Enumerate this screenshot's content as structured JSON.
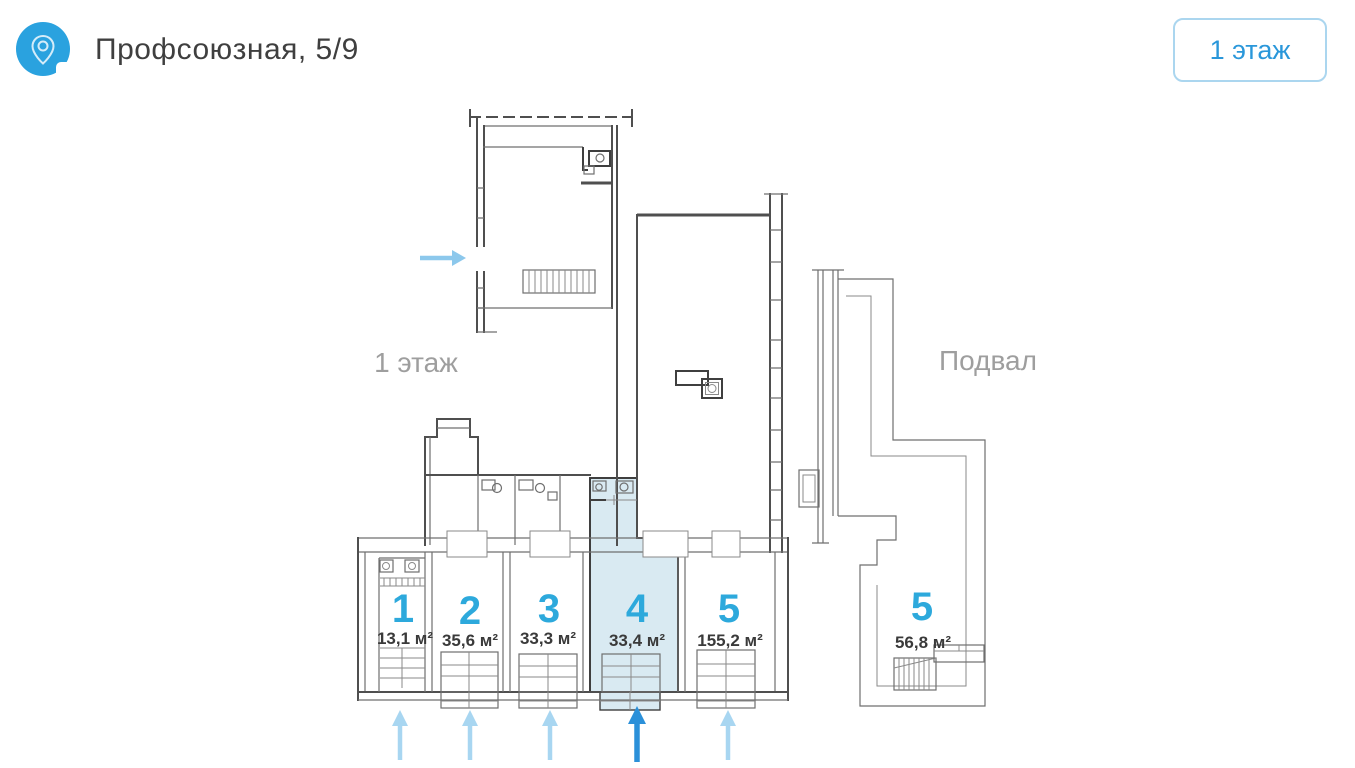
{
  "header": {
    "title": "Профсоюзная, 5/9",
    "floor_button": "1 этаж",
    "icon": "location-pin-icon"
  },
  "plan": {
    "floor_label": "1 этаж",
    "basement_label": "Подвал",
    "rooms": [
      {
        "number": "1",
        "area": "13,1 м²",
        "floor": "1 этаж",
        "highlighted": false
      },
      {
        "number": "2",
        "area": "35,6 м²",
        "floor": "1 этаж",
        "highlighted": false
      },
      {
        "number": "3",
        "area": "33,3 м²",
        "floor": "1 этаж",
        "highlighted": false
      },
      {
        "number": "4",
        "area": "33,4 м²",
        "floor": "1 этаж",
        "highlighted": true
      },
      {
        "number": "5",
        "area": "155,2 м²",
        "floor": "1 этаж",
        "highlighted": false
      },
      {
        "number": "5",
        "area": "56,8 м²",
        "floor": "Подвал",
        "highlighted": false
      }
    ],
    "entrance_arrows": {
      "bottom_count": 5,
      "highlighted_arrow_room": "4",
      "side_count": 1
    },
    "colors": {
      "accent_blue": "#2da9dc",
      "highlight_fill": "#d9eaf2",
      "arrow_light": "#a8d6f1",
      "arrow_dark": "#2b90d9",
      "label_gray": "#9e9e9e",
      "wall": "#4f4f4f",
      "button_border": "#abd6ef",
      "button_text": "#2a97da",
      "icon_bg": "#2aa2df"
    }
  }
}
